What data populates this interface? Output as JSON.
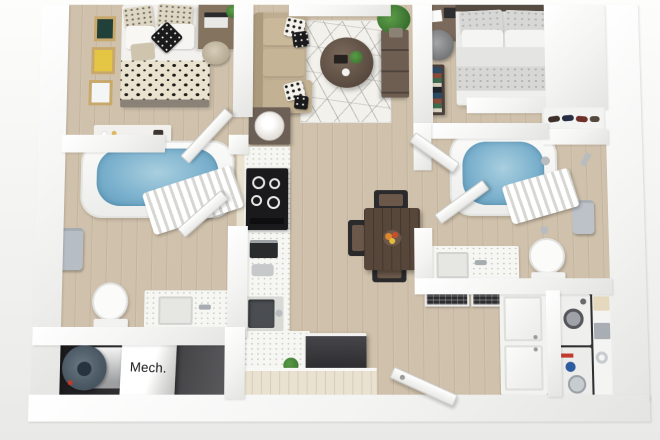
{
  "scene": {
    "type": "3d-apartment-floor-plan-rendering",
    "rooms": [
      "bedroom-1",
      "living-room",
      "bedroom-2",
      "bathroom-1",
      "bathroom-2",
      "kitchen",
      "dining-area",
      "mechanical-room",
      "laundry-closet",
      "entry-hall",
      "closet"
    ]
  },
  "labels": {
    "mech_room": "Mech."
  },
  "colors": {
    "background": "#f0f0ee",
    "walls": "#f5f5f4",
    "wood_floor": "#cfc1ab",
    "light_cabinet_wood": "#eae2d0",
    "mech_floor": "#2c2c2e",
    "laundry_floor": "#47474a",
    "bath_water": "#7db2ce",
    "sofa": "#beac8e",
    "rug": "#f2f1ec",
    "coffee_table": "#5f5046",
    "media_console": "#6e5e52",
    "dining_table": "#57463a",
    "dining_chairs": "#2a2a2c",
    "stove": "#1b1b1d",
    "kitchen_island": "#39393c",
    "countertop_speckled": "#f6f6f3",
    "fruit_accent": "#e0862c",
    "wall_art_green": "#21403a",
    "wall_art_yellow": "#e5c544",
    "plants": "#4c8a3e",
    "water_heater": "#4f5e6b",
    "towels": "#b8bec5",
    "appliances_white": "#efefed",
    "dryer_knob_red": "#c23b2e",
    "dryer_knob_blue": "#2d5d9f"
  }
}
